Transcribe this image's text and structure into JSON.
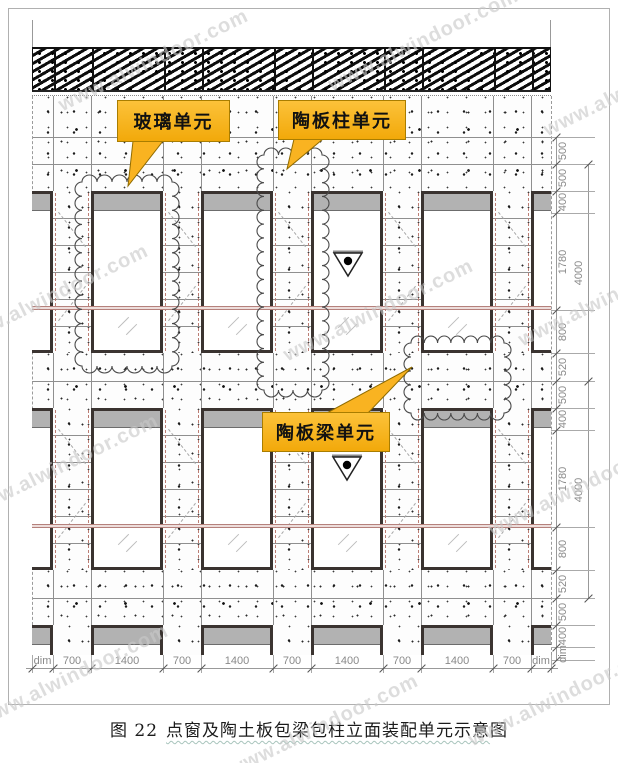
{
  "drawing": {
    "watermark": "www.alwindoor.com",
    "callouts": {
      "glass": "玻璃单元",
      "column": "陶板柱单元",
      "beam": "陶板梁单元"
    },
    "dimensions": {
      "bottom": [
        "dim",
        "700",
        "1400",
        "700",
        "1400",
        "700",
        "1400",
        "700",
        "1400",
        "700",
        "dim"
      ],
      "right_inner": [
        "500",
        "500",
        "400",
        "1780",
        "800",
        "520",
        "500",
        "400",
        "1780",
        "800",
        "520",
        "500",
        "400",
        "dim"
      ],
      "right_outer": [
        "4000",
        "4000"
      ]
    },
    "caption": {
      "lead": "图 22",
      "underlined": "点窗及陶土板包梁包柱立面装配单元示意",
      "tail": "图"
    },
    "colors": {
      "callout_fill": "#F9B321",
      "callout_border": "#A97D00",
      "window_frame": "#3A3330",
      "transom_red": "#B5817C",
      "dim_text": "#8A8A8A",
      "watermark_gray": "#C9C9C9"
    }
  }
}
